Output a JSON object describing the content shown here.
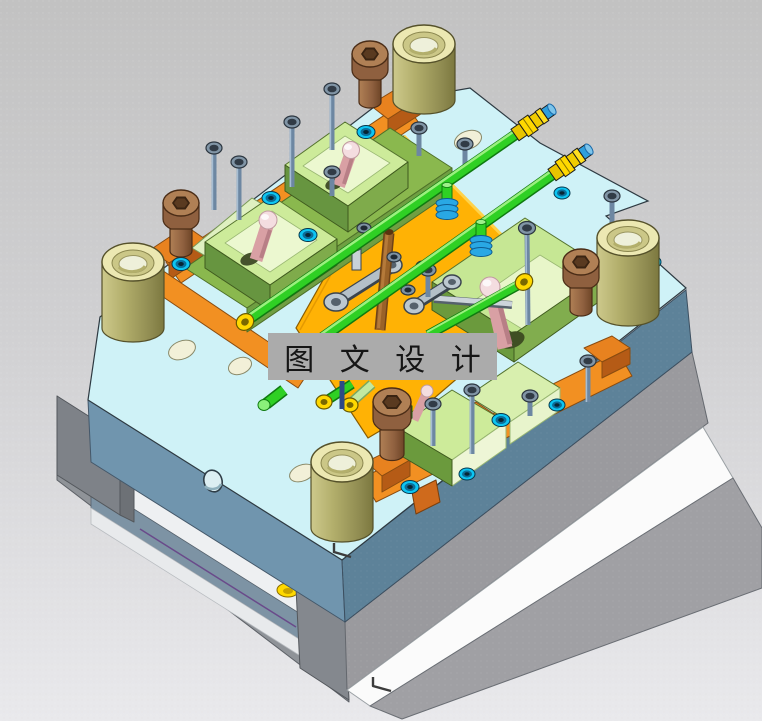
{
  "watermark": {
    "text": "图 文 设 计",
    "background_color": "#ababab",
    "text_color": "#161616"
  },
  "scene": {
    "type": "3d-cad-isometric-render",
    "subject": "injection-mold-assembly",
    "background_top": "#c2c2c2",
    "background_bottom": "#e9e9ec"
  },
  "colors": {
    "plate_top_cyan": "#cff2f7",
    "plate_front_left": "#7095ae",
    "plate_front_right": "#5d8299",
    "support_gray": "#9a9a9e",
    "clamp_plate_white": "#fbfbfb",
    "rail_orange": "#f29022",
    "rail_orange_dark": "#c3641a",
    "manifold_amber": "#ffb205",
    "insert_green_top": "#cdeb9a",
    "insert_green_side": "#6b9a3d",
    "cooling_pipe_green": "#2fd024",
    "fitting_yellow": "#ffd800",
    "fitting_blue_cap": "#2f9fdc",
    "bushing_brass": "#d9d594",
    "screw_brown": "#a87a50",
    "screw_steel": "#7a92aa",
    "screw_ring_cyan": "#0cc5f2",
    "angle_pin_pink": "#d9a0a4",
    "latch_gray": "#b4c0c8"
  },
  "parts": [
    {
      "name": "guide-bushing",
      "qty": 4
    },
    {
      "name": "brown-socket-screw",
      "qty": 4
    },
    {
      "name": "pneumatic-fitting",
      "qty": 2
    },
    {
      "name": "cooling-pipe-run",
      "qty": 3
    },
    {
      "name": "pipe-coil-fitting",
      "qty": 2
    },
    {
      "name": "mold-insert-block",
      "qty": 5
    },
    {
      "name": "pink-angle-pin",
      "qty": 4
    },
    {
      "name": "slide-latch",
      "qty": 2
    },
    {
      "name": "cyan-ring-screw",
      "qty": 10
    },
    {
      "name": "steel-cap-screw",
      "qty": 16
    },
    {
      "name": "corner-datum-mark",
      "qty": 2
    }
  ]
}
